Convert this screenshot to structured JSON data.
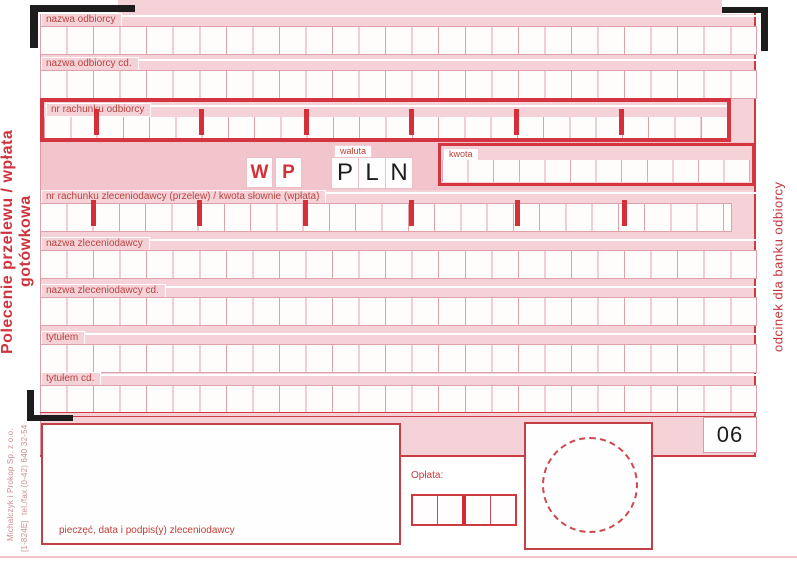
{
  "titles": {
    "left": "Polecenie przelewu / wpłata gotówkowa",
    "right": "odcinek dla banku odbiorcy"
  },
  "row_labels": {
    "r1": "nazwa odbiorcy",
    "r2": "nazwa odbiorcy cd.",
    "r3": "nr rachunku odbiorcy",
    "r4": "nr rachunku zleceniodawcy (przelew) / kwota słownie (wpłata)",
    "r5": "nazwa zleceniodawcy",
    "r6": "nazwa zleceniodawcy cd.",
    "r7": "tytułem",
    "r8": "tytułem cd."
  },
  "currency": {
    "label": "waluta",
    "value": [
      "P",
      "L",
      "N"
    ]
  },
  "wp": [
    "W",
    "P"
  ],
  "amount": {
    "label": "kwota"
  },
  "fee": {
    "label": "Opłata:"
  },
  "signature": {
    "label": "pieczęć, data i podpis(y) zleceniodawcy"
  },
  "slip_number": "06",
  "printer": {
    "name": "Michalczyk i Prokop Sp. z o.o.",
    "phone": "tel./fax (0-42) 640 32-54",
    "code": "[1-824E]"
  },
  "account_format": {
    "groups": [
      2,
      4,
      4,
      4,
      4,
      4,
      4
    ]
  },
  "colors": {
    "accent_red": "#d5303a",
    "line_red": "#cc3a42",
    "pink": "#f5d2d8",
    "pink_dark": "#f2c4cc",
    "grid_line": "#dfa2aa",
    "label_text": "#b8443f",
    "black": "#1c1c1c"
  }
}
